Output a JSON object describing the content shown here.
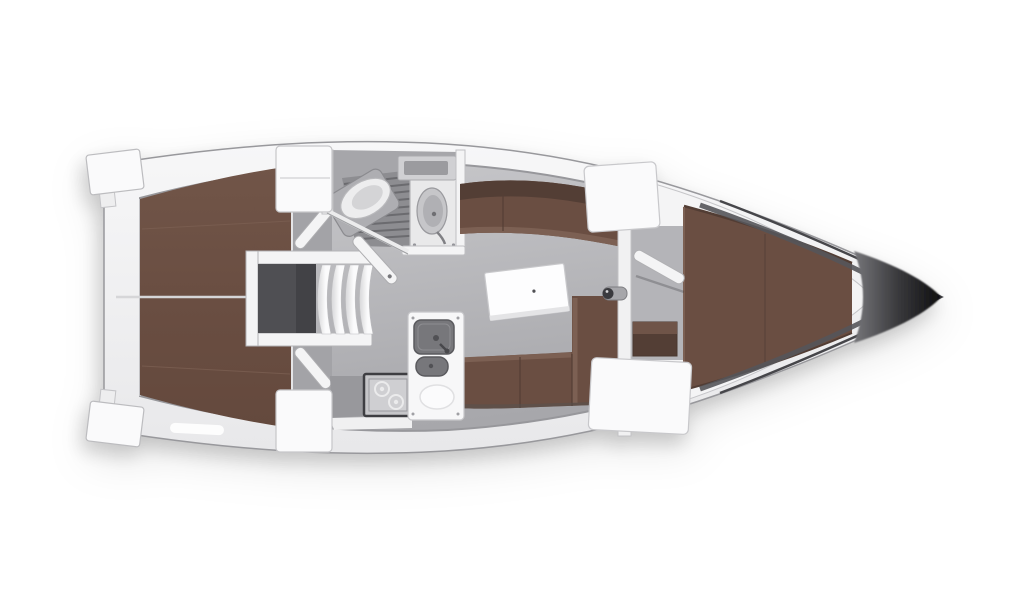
{
  "page": {
    "background": "#ffffff"
  },
  "plan": {
    "orientation": {
      "bow": "right",
      "stern": "left"
    },
    "areas": [
      {
        "id": "aft-berth-port",
        "label": "Aft double berth (port)"
      },
      {
        "id": "aft-berth-starboard",
        "label": "Aft double berth (starboard)"
      },
      {
        "id": "engine-compartment",
        "label": "Engine compartment under companionway"
      },
      {
        "id": "companionway-steps",
        "label": "Companionway steps"
      },
      {
        "id": "head",
        "label": "Head with shower grate, toilet and washbasin"
      },
      {
        "id": "salon",
        "label": "Salon with settees and table"
      },
      {
        "id": "galley",
        "label": "Galley with stove and twin sinks"
      },
      {
        "id": "forward-cabin",
        "label": "Forward V-berth cabin"
      }
    ]
  },
  "colors": {
    "background": "#ffffff",
    "hull_top": "#f7f7f8",
    "hull_bottom": "#e8e8ea",
    "hull_edge": "#98989c",
    "deck_white": "#fafafb",
    "wall_white": "#f4f4f5",
    "wall_edge": "#bdbdc0",
    "floor_light": "#c9c9cc",
    "floor_dark": "#a7a7ab",
    "corridor_grey": "#a3a3a7",
    "head_floor": "#a6a6aa",
    "berth_brown": "#6a4e42",
    "berth_dark": "#533e35",
    "berth_light": "#7c6053",
    "berth_divider": "#d6d6d8",
    "engine_grey": "#4f4f53",
    "engine_dark": "#424246",
    "step_light": "#fbfbfc",
    "step_shade": "#d7d7d9",
    "shower_grey": "#8d8d91",
    "slat_grey": "#6b6b6f",
    "fixture_light": "#ededee",
    "fixture_mid": "#c6c6c9",
    "metal_grey": "#77777b",
    "metal_dark": "#515155",
    "table_white": "#fdfdfe",
    "bow_start": "#76767a",
    "bow_mid": "#3a3a3d",
    "bow_end": "#0e0e10"
  }
}
